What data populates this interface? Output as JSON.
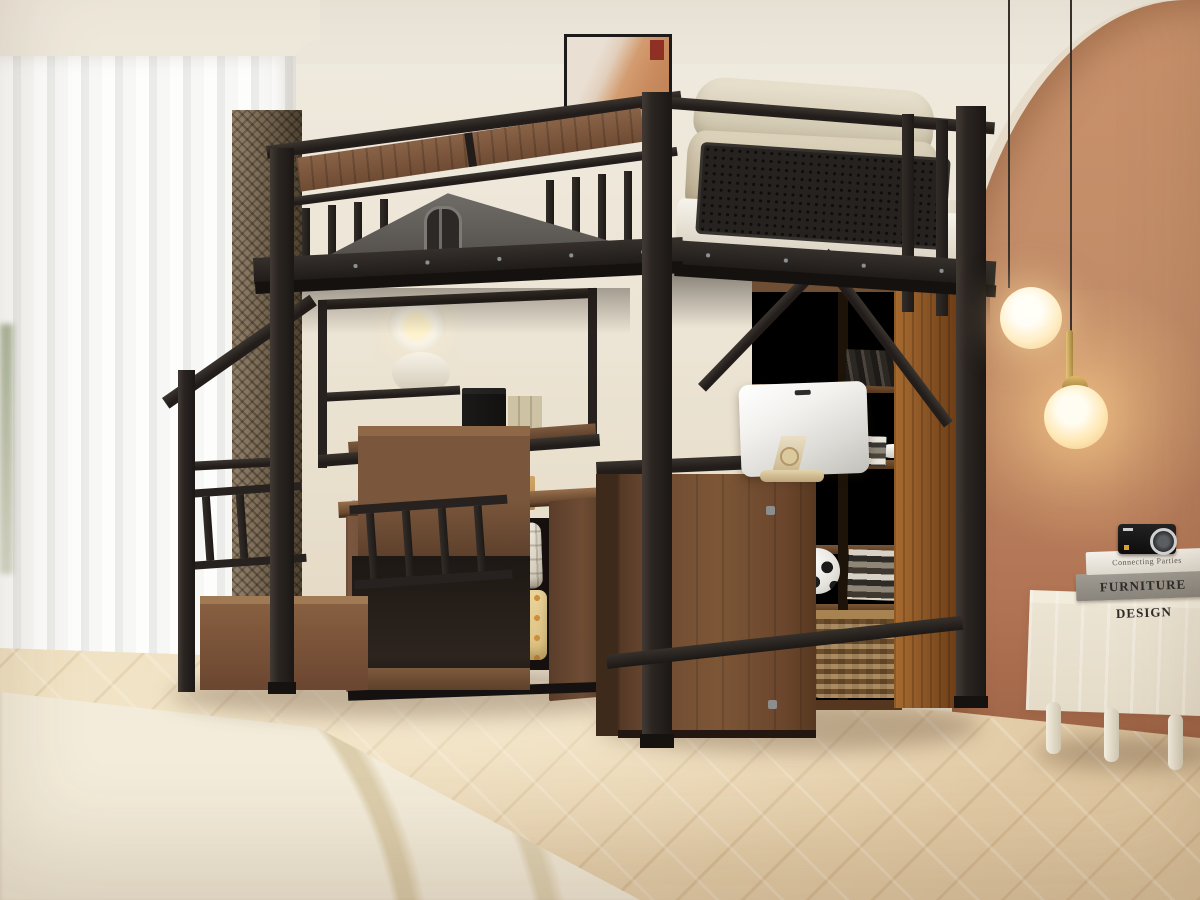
{
  "meta": {
    "domain": "Natural-Image",
    "subject": "Black metal loft bed with house-gable guardrail, built-in storage staircase, desk, shelving and wardrobe in a warm bedroom",
    "style": "interior product photograph"
  },
  "text": {
    "book_top_title": "Connecting Parties",
    "book_bottom_title": "FURNITURE DESIGN"
  },
  "palette": {
    "frame_black": "#2a2421",
    "walnut_wood": "#6b4a33",
    "rich_wood_panel": "#8a5526",
    "terracotta_wall": "#c08b67",
    "cream_wall": "#efe9dd",
    "floor_oak": "#e8d6b8",
    "rug_cream": "#f3ecda",
    "bedding_white": "#f4f1ea",
    "pillow_beige": "#d2c7ad",
    "gable_gray": "#66625e",
    "lamp_glow": "#ffe9bd",
    "brass_gold": "#c9a24e"
  },
  "objects": {
    "loft_bed": "black metal loft bed with wood-inlay top rail and gray house gable with arched window",
    "guard_panel": "perforated black metal headboard panel",
    "bedding": "white mattress with beige pillows",
    "staircase": "storage stairs with black spindle railings and walnut step boxes",
    "wardrobe": "open walnut cabinet with plaid and yellow folded blankets",
    "desk": "walnut pedestal desk with silver monitor on brass stand",
    "bookcase": "walnut cubby shelf with soccer ball, books and wicker basket",
    "sideboard": "cream fluted sideboard with two books and a black compact camera",
    "pendant_lights": "two brass glass-globe pendant lamps",
    "wall_sconces": "two round white wall lamps, upper one lit",
    "wall_art": "framed terracotta abstract print",
    "curtains": "white sheer curtain with brown mesh drape",
    "floor": "light oak herringbone floor",
    "rug": "cream rug with thin beige arc lines",
    "accent_wall": "terracotta arched accent wall"
  }
}
